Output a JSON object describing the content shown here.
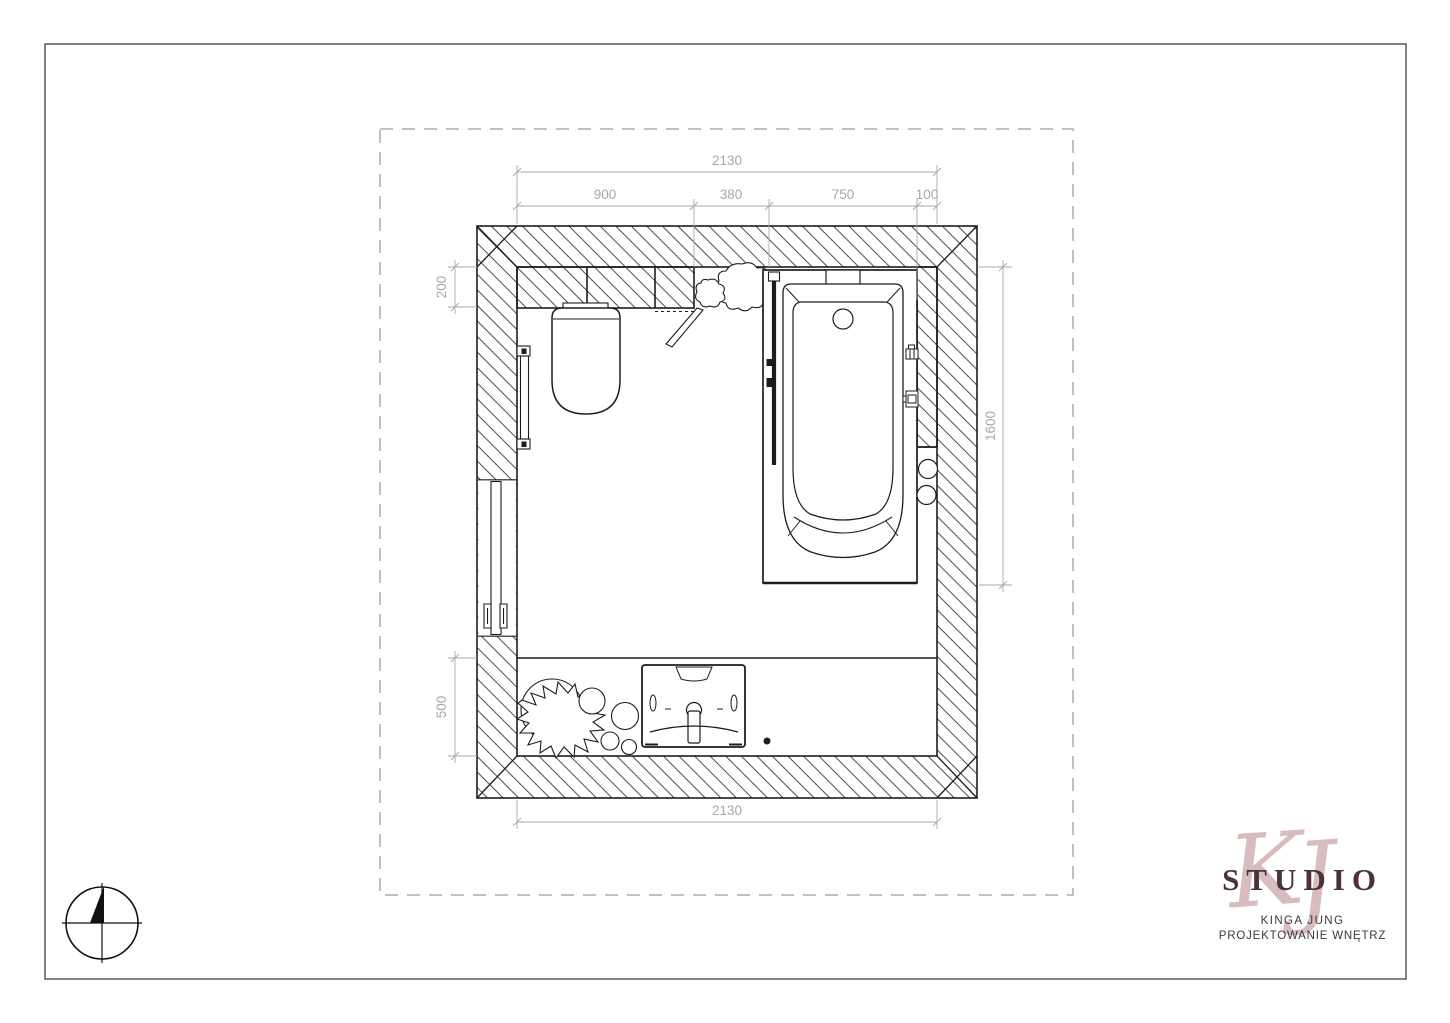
{
  "plan": {
    "title_semantic": "bathroom-floor-plan",
    "dimensions": {
      "top_total": "2130",
      "top_segments": [
        "900",
        "380",
        "750",
        "100"
      ],
      "left_top": "200",
      "left_bottom": "500",
      "right_side": "1600",
      "bottom_total": "2130"
    },
    "fixtures": [
      "toilet",
      "bathtub",
      "glass-screen",
      "washbasin",
      "towel-rail",
      "radiator",
      "plant",
      "plant",
      "headrest",
      "drain"
    ],
    "colors": {
      "ink": "#1d1d1d",
      "dimension": "#a8a8a8",
      "boundary_dash": "#9e9e9e"
    }
  },
  "logo": {
    "monogram_k": "K",
    "monogram_j": "J",
    "studio": "STUDIO",
    "name": "KINGA JUNG",
    "tagline": "PROJEKTOWANIE WNĘTRZ",
    "monogram_color": "#d9bdbe",
    "studio_color": "#4a323c",
    "text_color": "#3a3a3a"
  }
}
